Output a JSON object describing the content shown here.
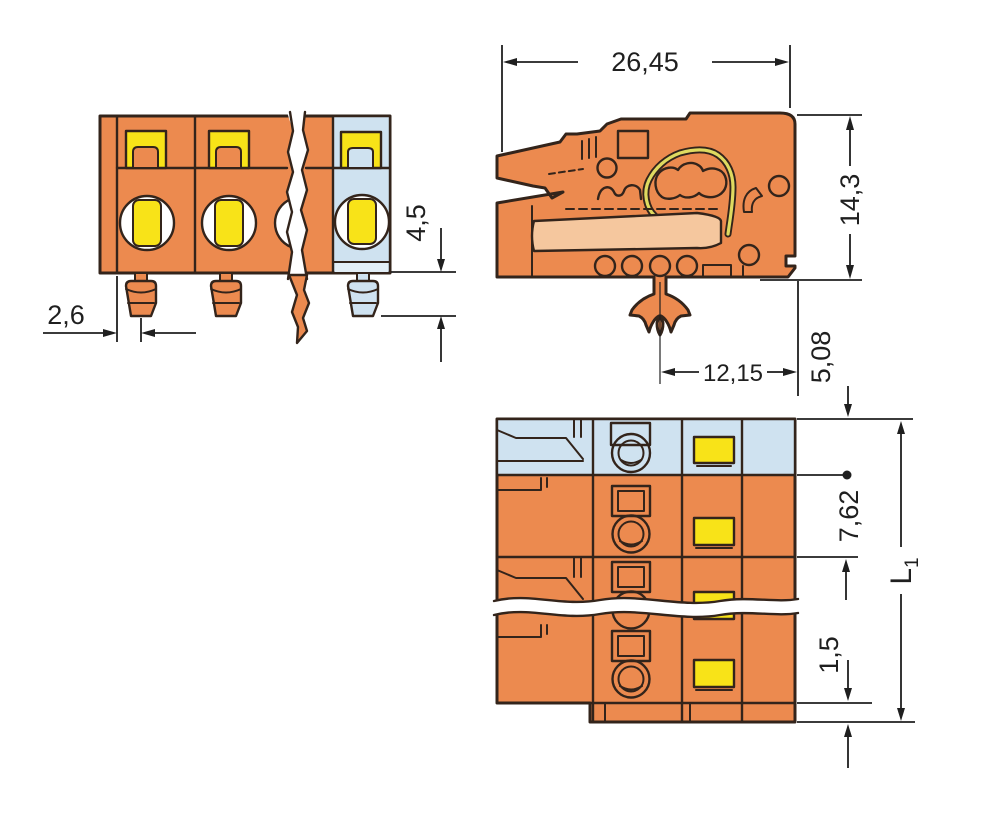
{
  "dims": {
    "total_width": "26,45",
    "housing_height": "14,3",
    "pin_length": "4,5",
    "pin_offset": "2,6",
    "foot_to_edge": "12,15",
    "edge_to_row": "5,08",
    "pole_pitch": "7,62",
    "bottom_step": "1,5",
    "total_length_main": "L",
    "total_length_sub": "1"
  },
  "colors": {
    "body_orange": "#EC8A4F",
    "body_orange_light": "#F5C79E",
    "body_blue": "#CFE2F0",
    "body_blue_light": "#E2EEF6",
    "accent_yellow": "#F8E318",
    "spring_yellow": "#DFDA60",
    "outline": "#33241B",
    "dim_line": "#1F1F1F",
    "white": "#FFFFFF",
    "background": "#FFFFFF"
  }
}
